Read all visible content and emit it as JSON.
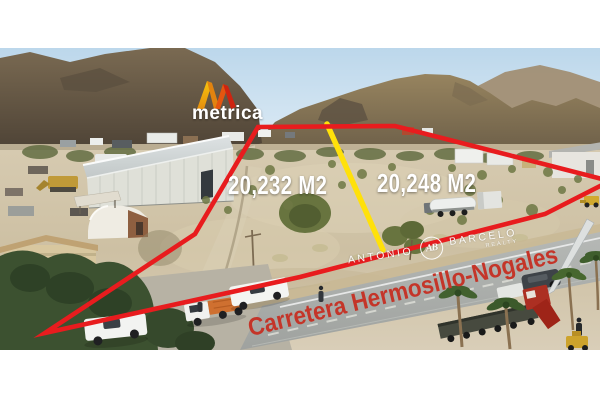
{
  "branding": {
    "logo_text": "metrica"
  },
  "annotations": {
    "lot_left_area": "20,232 M2",
    "lot_right_area": "20,248 M2",
    "road_label": "Carretera Hermosillo-Nogales"
  },
  "watermark": {
    "first_name": "ANTONIO",
    "monogram": "AB",
    "last_name": "BARCELO",
    "tagline": "REALTY"
  },
  "colors": {
    "boundary_red": "#e81c1e",
    "divider_yellow": "#ffe10a",
    "area_label": "#ffffff",
    "road_label": "#c43529",
    "logo_gold": "#f6c50e",
    "logo_orange": "#e2830f",
    "logo_red": "#ce2410"
  }
}
